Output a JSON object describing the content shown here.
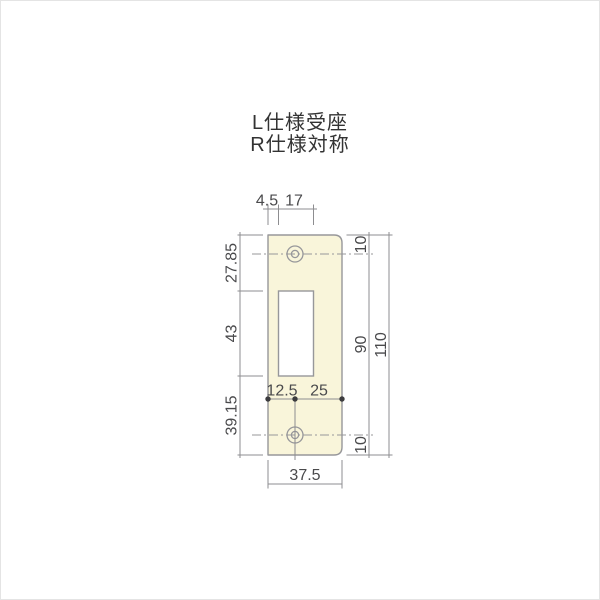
{
  "title": {
    "line1": "L仕様受座",
    "line2": "R仕様対称"
  },
  "drawing": {
    "kind": "strike-plate-dimension-diagram",
    "dimensions": {
      "top": {
        "left_edge_to_cutout": "4.5",
        "cutout_width": "17"
      },
      "left": {
        "top_to_cutout_top": "27.85",
        "cutout_height": "43",
        "cutout_bottom_to_bottom": "39.15"
      },
      "right": {
        "top_to_hole_center": "10",
        "hole_center_to_hole_center": "90",
        "hole_center_to_bottom": "10",
        "overall_height": "110"
      },
      "bottom": {
        "left_edge_to_hole_center": "12.5",
        "hole_center_to_right_edge": "25",
        "overall_width": "37.5"
      }
    },
    "features": {
      "screw_holes": 2,
      "rect_cutout": 1
    },
    "colors": {
      "plate_fill": "#f9f5da",
      "outline": "#97979a",
      "dim_line": "#8d8d90",
      "dim_dot": "#3c3c3e",
      "text": "#4a4a4c",
      "title_text": "#333333",
      "frame_border": "#e4e4e4"
    }
  }
}
